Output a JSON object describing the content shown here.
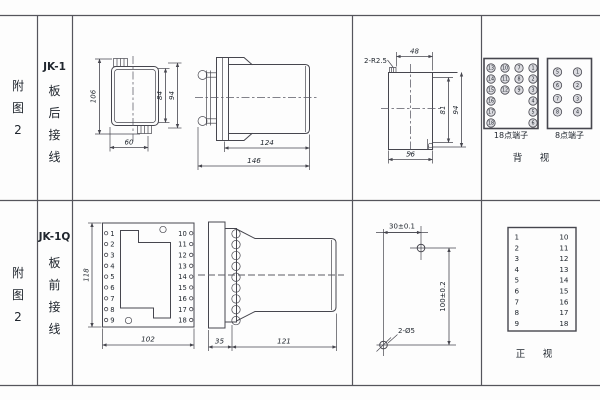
{
  "panel": {
    "row1": {
      "fig_label": [
        "附",
        "图",
        "2"
      ],
      "model": "JK-1",
      "wiring": [
        "板",
        "后",
        "接",
        "线"
      ]
    },
    "row2": {
      "fig_label": [
        "附",
        "图",
        "2"
      ],
      "model": "JK-1Q",
      "wiring": [
        "板",
        "前",
        "接",
        "线"
      ]
    }
  },
  "jk1": {
    "front_view": {
      "dim_total_height": "106",
      "dim_inner_height": "84",
      "dim_outer_height": "94",
      "dim_width": "60"
    },
    "side_view": {
      "dim_body_length": "124",
      "dim_total_length": "146"
    },
    "rear_view": {
      "radius_note": "2-R2.5",
      "dim_top_width": "48",
      "dim_inner_depth": "81",
      "dim_outer_depth": "94",
      "dim_bottom_width": "56"
    },
    "terminals18": {
      "label": "18点端子",
      "col1": [
        "13",
        "14",
        "15",
        "16",
        "17",
        "18"
      ],
      "col2": [
        "10",
        "11",
        "12"
      ],
      "col3": [
        "7",
        "8",
        "9"
      ],
      "col4": [
        "1",
        "2",
        "3",
        "4",
        "5",
        "6"
      ]
    },
    "terminals8": {
      "label": "8点端子",
      "col1": [
        "5",
        "6",
        "7",
        "8"
      ],
      "col2": [
        "1",
        "2",
        "3",
        "4"
      ]
    },
    "view_label": "背　视"
  },
  "jk1q": {
    "front_view": {
      "dim_height": "118",
      "dim_width": "102",
      "left_terminals": [
        "1",
        "2",
        "3",
        "4",
        "5",
        "6",
        "7",
        "8",
        "9"
      ],
      "right_terminals": [
        "10",
        "11",
        "12",
        "13",
        "14",
        "15",
        "16",
        "17",
        "18"
      ]
    },
    "side_view": {
      "dim_plate": "35",
      "dim_body": "121"
    },
    "drill_plan": {
      "dim_horizontal": "30±0.1",
      "dim_vertical": "100±0.2",
      "holes_note": "2-Ø5"
    },
    "terminal_table": {
      "left": [
        "1",
        "2",
        "3",
        "4",
        "5",
        "6",
        "7",
        "8",
        "9"
      ],
      "right": [
        "10",
        "11",
        "12",
        "13",
        "14",
        "15",
        "16",
        "17",
        "18"
      ],
      "view_label": "正　视"
    }
  }
}
